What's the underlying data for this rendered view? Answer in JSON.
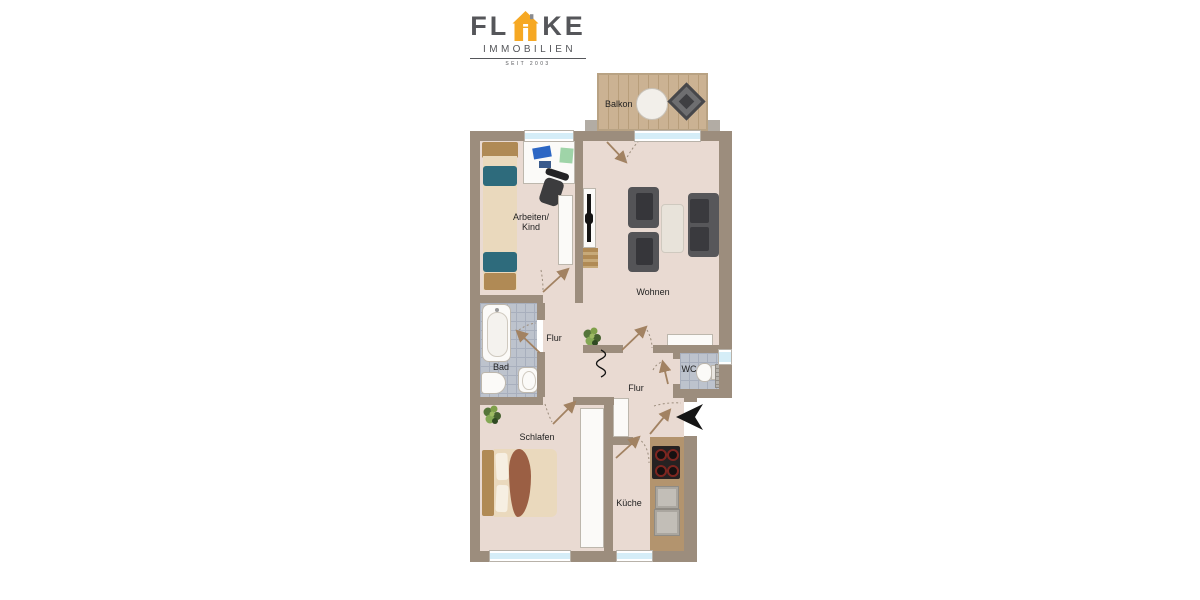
{
  "logo": {
    "brand_prefix": "FL",
    "brand_suffix": "KE",
    "line2": "IMMOBILIEN",
    "line3": "SEIT 2003",
    "colors": {
      "text_gray": "#55565A",
      "house_orange": "#F6A823"
    }
  },
  "floorplan": {
    "labels": {
      "balkon": "Balkon",
      "arbeiten_line1": "Arbeiten/",
      "arbeiten_line2": "Kind",
      "wohnen": "Wohnen",
      "flur_upper": "Flur",
      "flur_lower": "Flur",
      "bad": "Bad",
      "wc": "WC",
      "schlafen": "Schlafen",
      "kueche": "Küche"
    },
    "colors": {
      "wall": "#9C8D7D",
      "floor": "#E9DAD2",
      "bath_tile": "#BDC3CD",
      "balcony_wood": "#C9B190",
      "furniture_dark": "#4A4A4C",
      "bed_accent_teal": "#2E6B7C",
      "wood_furniture": "#B08A55",
      "entrance_arrow": "#151515"
    },
    "icons": [
      "entrance-arrow-icon",
      "plant-icon",
      "door-swing-icon",
      "squiggle-symbol-icon",
      "house-icon"
    ]
  }
}
